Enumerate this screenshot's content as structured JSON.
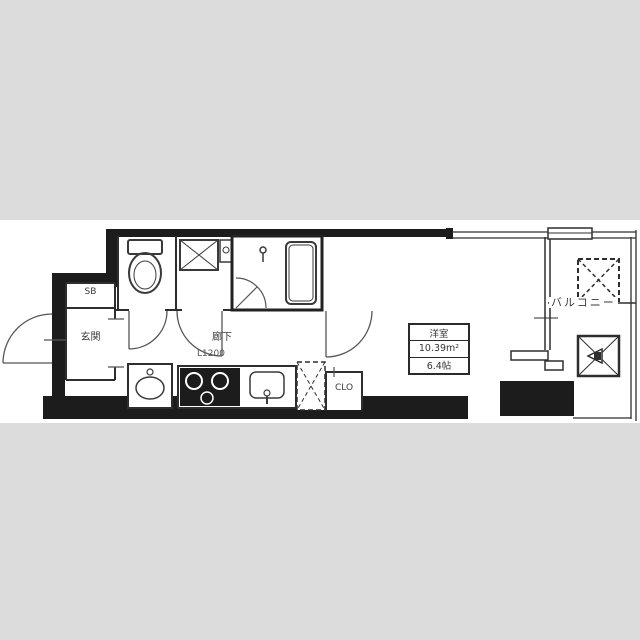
{
  "floor_plan": {
    "labels": {
      "shoe_box": "SB",
      "entrance": "玄関",
      "corridor": "廊下",
      "corridor_width": "L1200",
      "closet": "CLO",
      "balcony": "バルコニー"
    },
    "room": {
      "name": "洋室",
      "area_m2": "10.39m²",
      "area_jo": "6.4帖"
    },
    "colors": {
      "background": "#dcdcdc",
      "paper": "#ffffff",
      "wall": "#1c1c1c",
      "thin_line": "#2e2e2e"
    }
  }
}
